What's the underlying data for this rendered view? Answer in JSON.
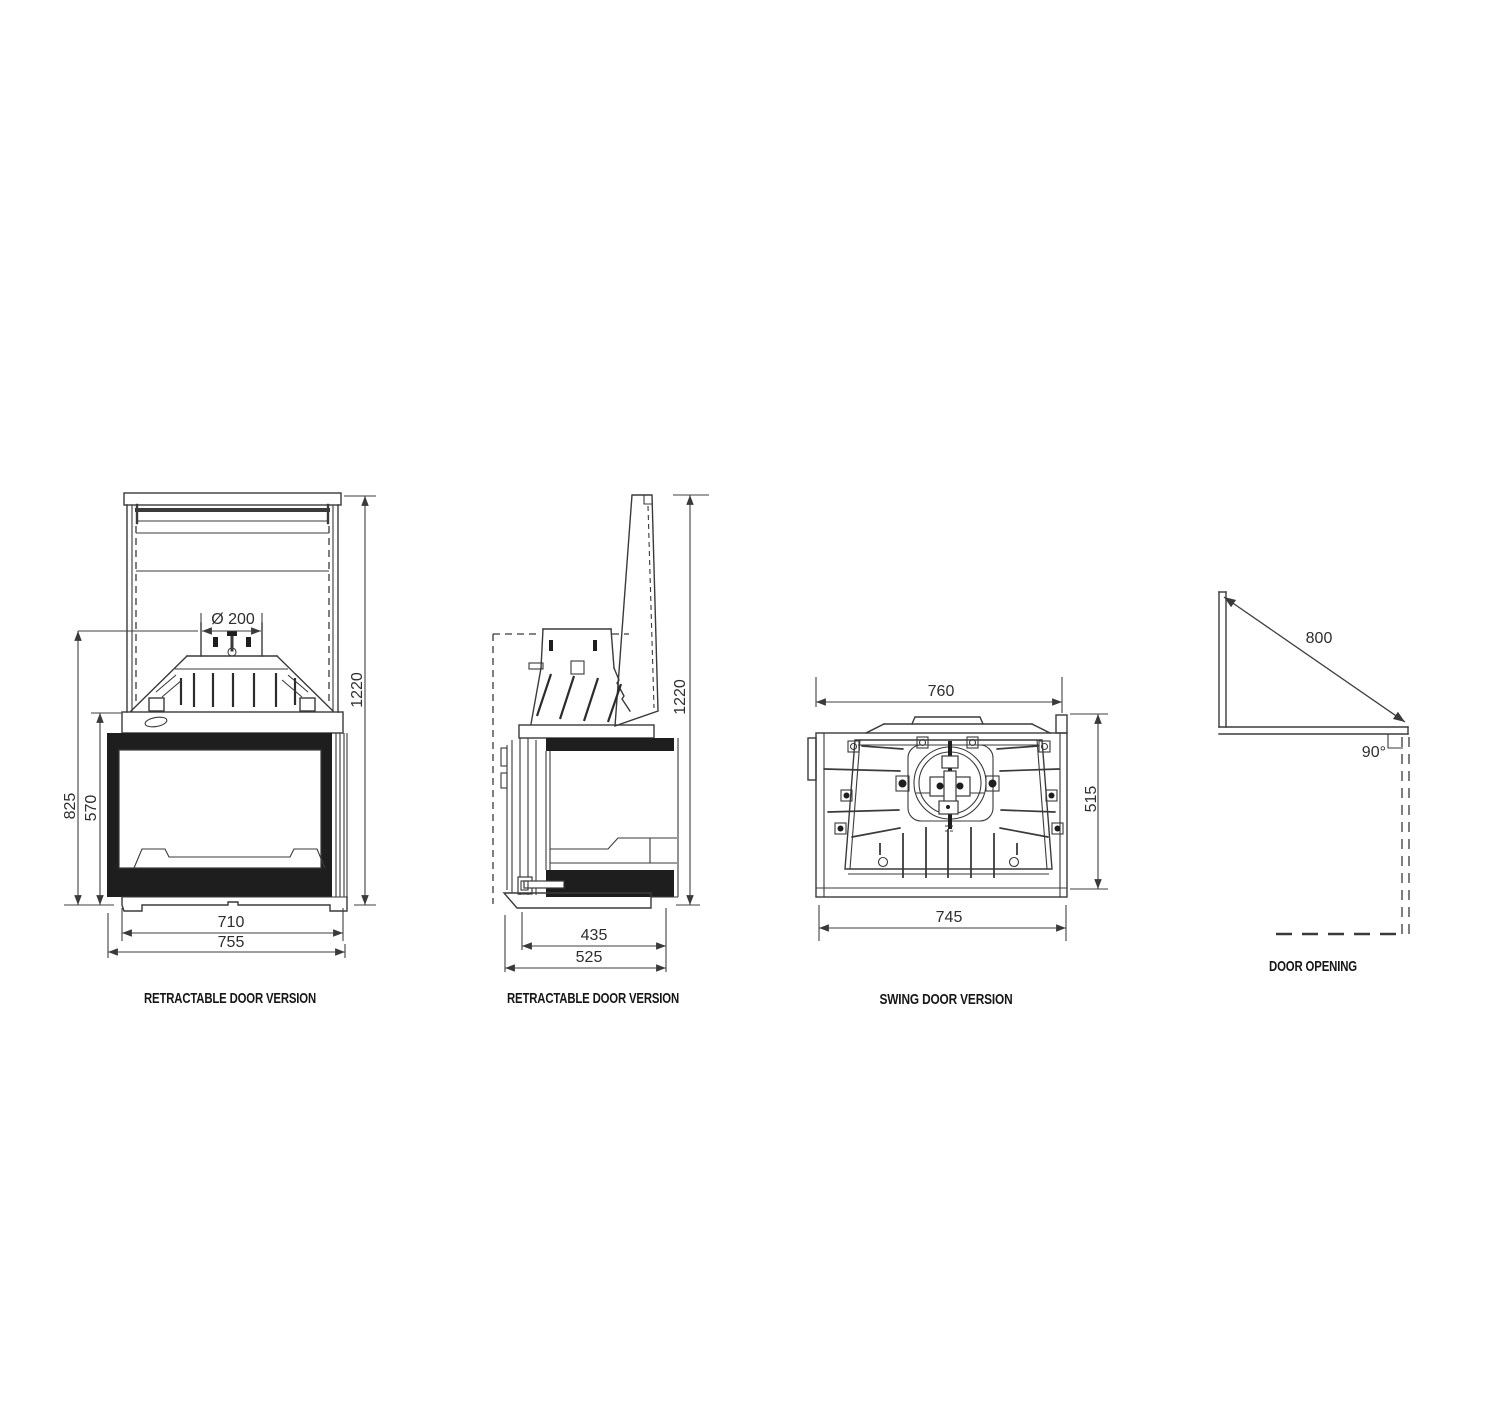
{
  "drawing": {
    "background": "#ffffff",
    "line_color": "#3a3a3a",
    "text_color": "#2e2e2e"
  },
  "views": [
    {
      "id": "front-retractable",
      "caption": "RETRACTABLE DOOR VERSION",
      "dimensions": {
        "flue_diameter": "Ø 200",
        "overall_height": "1220",
        "firebox_height": "825",
        "glass_height": "570",
        "inner_width": "710",
        "overall_width": "755"
      }
    },
    {
      "id": "side-retractable",
      "caption": "RETRACTABLE DOOR VERSION",
      "dimensions": {
        "overall_height": "1220",
        "inner_depth": "435",
        "overall_depth": "525"
      }
    },
    {
      "id": "rear-swing",
      "caption": "SWING DOOR VERSION",
      "dimensions": {
        "top_width": "760",
        "height": "515",
        "bottom_width": "745"
      }
    },
    {
      "id": "door-opening",
      "caption": "DOOR OPENING",
      "dimensions": {
        "door_travel": "800",
        "opening_angle": "90°"
      }
    }
  ]
}
